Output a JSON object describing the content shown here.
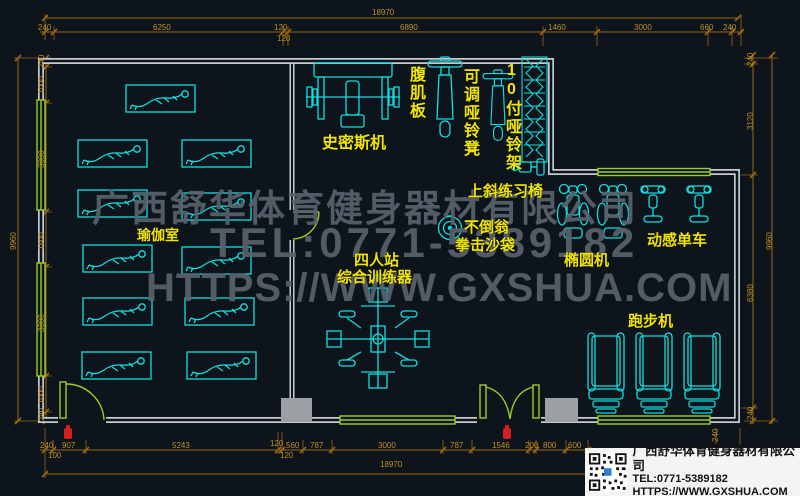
{
  "plan": {
    "type": "gym-equipment-floor-plan"
  },
  "labels": {
    "yoga_room": "瑜伽室",
    "smith_machine": "史密斯机",
    "ab_board": "腹肌板",
    "adjustable_dumbbell_bench": "可调哑铃凳",
    "dumbbell_rack": "10付哑铃架",
    "incline_chair": "上斜练习椅",
    "tumbler": "不倒翁",
    "punching_bag": "拳击沙袋",
    "four_station_line1": "四人站",
    "four_station_line2": "综合训练器",
    "elliptical": "椭圆机",
    "spin_bike": "动感单车",
    "treadmill": "跑步机"
  },
  "dimensions": {
    "top_total": "18970",
    "top": [
      "240",
      "6250",
      "120",
      "6890",
      "1460",
      "3000",
      "660",
      "240"
    ],
    "top_extra": "120",
    "left_total": "9960",
    "left": [
      "240",
      "1000",
      "3000",
      "1500",
      "3000",
      "1000",
      "240"
    ],
    "right_total": "9960",
    "right": [
      "240",
      "3120",
      "6380",
      "240"
    ],
    "bottom": [
      "240",
      "907",
      "5243",
      "120",
      "560",
      "787",
      "3000",
      "787",
      "1546",
      "200",
      "800",
      "600"
    ],
    "bottom_extra_100": "100",
    "bottom_extra_120": "120",
    "bottom_total": "18970"
  },
  "watermark": {
    "line1": "广西舒华体育健身器材有限公司",
    "line2": "TEL:0771-5389182",
    "line3": "HTTPS://WWW.GXSHUA.COM"
  },
  "logo": {
    "company": "广西舒华体育健身器材有限公司",
    "tel": "TEL:0771-5389182",
    "url": "HTTPS://WWW.GXSHUA.COM"
  },
  "colors": {
    "background": "#0d141b",
    "wall": "#c6cbd0",
    "equipment": "#12dede",
    "label": "#f0e400",
    "dimension_line": "#9c6716",
    "dimension_text": "#c09020",
    "window": "#9ccd2a",
    "watermark": "#5a626d",
    "fire_point": "#d41f1f"
  }
}
